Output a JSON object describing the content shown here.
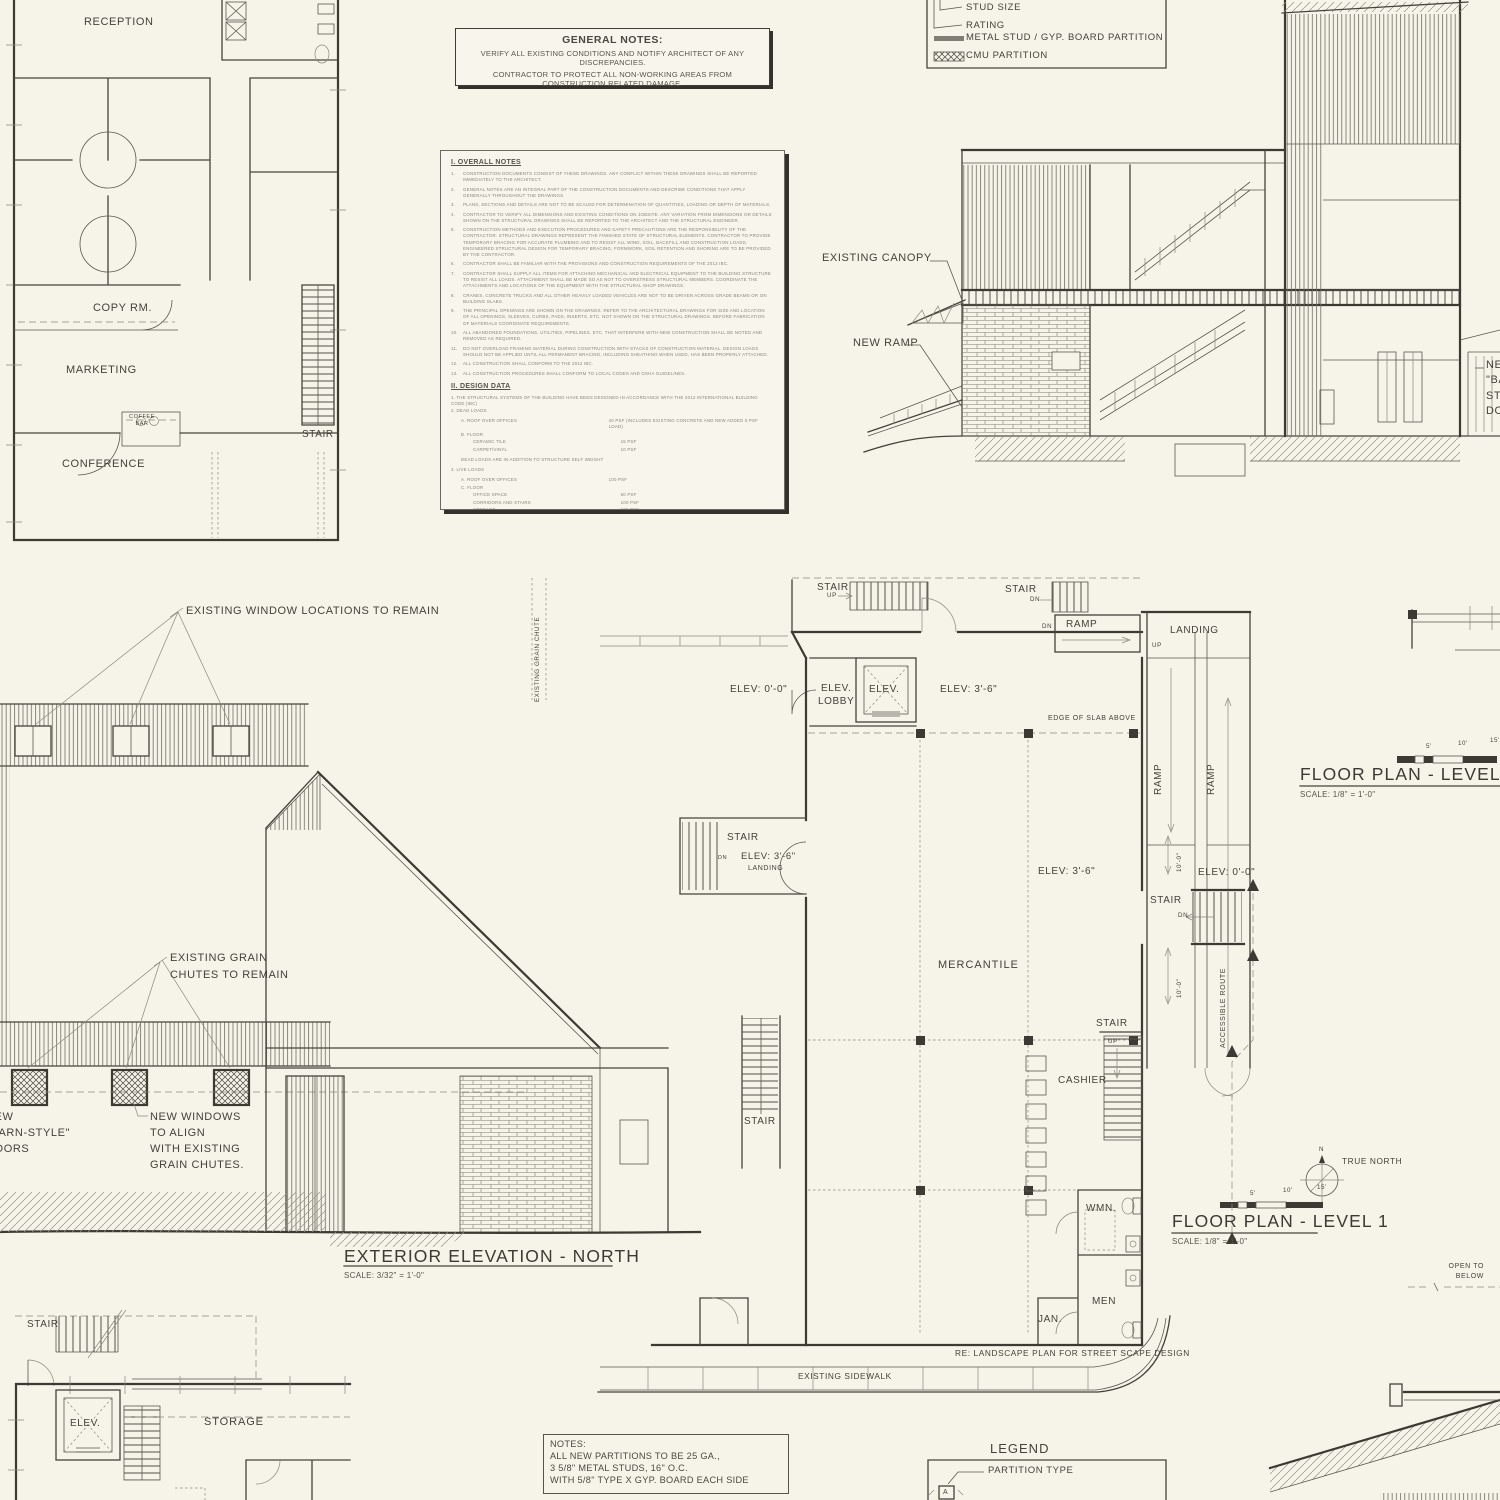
{
  "colors": {
    "background": "#f6f3e9",
    "ink": "#3f3d36",
    "ink_light": "#8a887c"
  },
  "office_plan": {
    "reception": "RECEPTION",
    "copy_room": "COPY RM.",
    "marketing": "MARKETING",
    "coffee_bar": "COFFEE\nBAR",
    "conference": "CONFERENCE",
    "stair": "STAIR"
  },
  "general_notes": {
    "title": "GENERAL NOTES:",
    "line1": "VERIFY ALL EXISTING CONDITIONS  AND NOTIFY ARCHITECT OF ANY DISCREPANCIES.",
    "line2": "CONTRACTOR TO PROTECT ALL NON-WORKING AREAS FROM CONSTRUCTION RELATED DAMAGE."
  },
  "notes_doc": {
    "section1_title": "I. OVERALL NOTES",
    "overall_notes": [
      {
        "n": "1.",
        "text": "CONSTRUCTION DOCUMENTS CONSIST OF THESE DRAWINGS. ANY CONFLICT WITHIN THESE DRAWINGS SHALL BE REPORTED IMMEDIATELY TO THE ARCHITECT."
      },
      {
        "n": "2.",
        "text": "GENERAL NOTES ARE AN INTEGRAL PART OF THE CONSTRUCTION DOCUMENTS AND DESCRIBE CONDITIONS THAT APPLY GENERALLY THROUGHOUT THE DRAWINGS."
      },
      {
        "n": "3.",
        "text": "PLANS, SECTIONS AND DETAILS ARE NOT TO BE SCALED FOR DETERMINATION OF QUANTITIES, LOADING OR DEPTH OF MATERIALS."
      },
      {
        "n": "4.",
        "text": "CONTRACTOR TO VERIFY ALL DIMENSIONS AND EXISTING CONDITIONS ON JOBSITE. ANY VARIATION FROM DIMENSIONS OR DETAILS SHOWN ON THE STRUCTURAL DRAWINGS SHALL BE REPORTED TO THE ARCHITECT AND THE STRUCTURAL ENGINEER."
      },
      {
        "n": "5.",
        "text": "CONSTRUCTION METHODS AND EXECUTION PROCEDURES AND SAFETY PRECAUTIONS ARE THE RESPONSIBILITY OF THE CONTRACTOR. STRUCTURAL DRAWINGS REPRESENT THE FINISHED STATE OF STRUCTURAL ELEMENTS. CONTRACTOR TO PROVIDE TEMPORARY BRACING FOR ACCURATE PLUMBING AND TO RESIST ALL WIND, SOIL, BACKFILL AND CONSTRUCTION LOADS. ENGINEERED STRUCTURAL DESIGN FOR TEMPORARY BRACING, FORMWORK, SOIL RETENTION AND SHORING ARE TO BE PROVIDED BY THE CONTRACTOR."
      },
      {
        "n": "6.",
        "text": "CONTRACTOR SHALL BE FAMILIAR WITH THE PROVISIONS AND CONSTRUCTION REQUIREMENTS OF THE 2012 IBC."
      },
      {
        "n": "7.",
        "text": "CONTRACTOR SHALL SUPPLY ALL ITEMS FOR ATTACHING MECHANICAL AND ELECTRICAL EQUIPMENT TO THE BUILDING STRUCTURE TO RESIST ALL LOADS. ATTACHMENT SHALL BE MADE SO AS NOT TO OVERSTRESS STRUCTURAL MEMBERS. COORDINATE THE ATTACHMENTS AND LOCATIONS OF THE EQUIPMENT WITH THE STRUCTURAL SHOP DRAWINGS."
      },
      {
        "n": "8.",
        "text": "CRANES, CONCRETE TRUCKS AND ALL OTHER HEAVILY LOADED VEHICLES ARE NOT TO BE DRIVEN ACROSS GRADE BEAMS OR ON BUILDING SLABS."
      },
      {
        "n": "9.",
        "text": "THE PRINCIPAL OPENINGS ARE SHOWN ON THE DRAWINGS. REFER TO THE ARCHITECTURAL DRAWINGS FOR SIZE AND LOCATION OF ALL OPENINGS, SLEEVES, CURBS, PADS, INSERTS, ETC. NOT SHOWN ON THE STRUCTURAL DRAWINGS. BEFORE FABRICATION OF MATERIALS COORDINATE REQUIREMENTS."
      },
      {
        "n": "10.",
        "text": "ALL ABANDONED FOUNDATIONS, UTILITIES, PIPELINES, ETC. THAT INTERFERE WITH NEW CONSTRUCTION SHALL BE NOTED AND REMOVED AS REQUIRED."
      },
      {
        "n": "11.",
        "text": "DO NOT OVERLOAD FRAMING MATERIAL DURING CONSTRUCTION WITH STACKS OF CONSTRUCTION MATERIAL. DESIGN LOADS SHOULD NOT BE APPLIED UNTIL ALL PERMANENT BRACING, INCLUDING SHEATHING WHEN USED, HAS BEEN PROPERLY ATTACHED."
      },
      {
        "n": "12.",
        "text": "ALL CONSTRUCTION SHALL CONFORM TO THE 2012 IBC."
      },
      {
        "n": "13.",
        "text": "ALL CONSTRUCTION PROCEDURES SHALL CONFORM TO LOCAL CODES AND OSHA GUIDELINES."
      }
    ],
    "section2_title": "II. DESIGN DATA",
    "design_data": [
      {
        "t": "1.   THE STRUCTURAL SYSTEMS OF THE BUILDING HAVE BEEN DESIGNED IN ACCORDANCE WITH THE 2012 INTERNATIONAL BUILDING CODE (IBC)",
        "v": ""
      },
      {
        "t": "2.   DEAD LOADS",
        "v": ""
      },
      {
        "t": "A. ROOF OVER OFFICES",
        "v": "40 PSF (INCLUDES EXISTING CONCRETE AND NEW ADDED 5 PSF LOAD)"
      },
      {
        "t": "B. FLOOR",
        "v": ""
      },
      {
        "t": "CERAMIC TILE",
        "v": "15 PSF"
      },
      {
        "t": "CARPET/VINYL",
        "v": "10 PSF"
      },
      {
        "t": "DEAD LOADS ARE IN ADDITION TO STRUCTURE SELF WEIGHT",
        "v": ""
      },
      {
        "t": "3.   LIVE LOADS",
        "v": ""
      },
      {
        "t": "A. ROOF OVER OFFICES",
        "v": "100 PSF"
      },
      {
        "t": "C. FLOOR",
        "v": ""
      },
      {
        "t": "OFFICE SPACE",
        "v": "50 PSF"
      },
      {
        "t": "CORRIDORS AND STAIRS",
        "v": "100 PSF"
      },
      {
        "t": "STORAGE",
        "v": "125 PSF"
      },
      {
        "t": "D. GUARDRAILS AND HANDRAILS",
        "v": "50 PLF OR 200 LBS IN ANY DIRECTION AT ANY POINT ALONG THE TOP"
      },
      {
        "t": "4.   WIND",
        "v": ""
      },
      {
        "t": "A. SPEED",
        "v": "90 MPH"
      },
      {
        "t": "B. OCCUPANCY CATEGORY",
        "v": "II"
      },
      {
        "t": "C. IMPORTANCE FACTOR",
        "v": "1.0"
      },
      {
        "t": "D. EXPOSURE",
        "v": "B"
      }
    ]
  },
  "legend_top": {
    "stud_size": "STUD SIZE",
    "rating": "RATING",
    "metal_partition": "METAL STUD / GYP. BOARD PARTITION",
    "cmu_partition": "CMU PARTITION"
  },
  "section_view": {
    "existing_canopy": "EXISTING CANOPY",
    "new_ramp": "NEW RAMP",
    "barn_doors_label": "NEW\n\"BARN-STYLE\"\nDOORS"
  },
  "elevation": {
    "windows_note": "EXISTING WINDOW LOCATIONS TO REMAIN",
    "chutes_note": "EXISTING GRAIN\nCHUTES TO REMAIN",
    "new_windows_note": "NEW WINDOWS\nTO ALIGN\nWITH EXISTING\nGRAIN CHUTES.",
    "title": "EXTERIOR ELEVATION - NORTH",
    "scale": "SCALE: 3/32\" = 1'-0\""
  },
  "plan1": {
    "stair": "STAIR",
    "ramp": "RAMP",
    "landing": "LANDING",
    "elev_lobby": "ELEV.\nLOBBY",
    "elev": "ELEV.",
    "elev_0": "ELEV: 0'-0\"",
    "elev_36": "ELEV: 3'-6\"",
    "edge_of_slab": "EDGE OF SLAB ABOVE",
    "mercantile": "MERCANTILE",
    "cashier": "CASHIER",
    "accessible_route": "ACCESSIBLE ROUTE",
    "wmn": "WMN.",
    "men": "MEN",
    "jan": "JAN.",
    "landing_small": "LANDING",
    "up": "UP",
    "dn": "DN",
    "dim_10": "10'-0\"",
    "grain_chute": "EXISTING GRAIN CHUTE",
    "re_landscape": "RE: LANDSCAPE PLAN FOR STREET SCAPE DESIGN",
    "sidewalk": "EXISTING SIDEWALK"
  },
  "plan1_title": {
    "title": "FLOOR PLAN - LEVEL 1",
    "scale": "SCALE: 1/8\" = 1'-0\"",
    "true_north": "TRUE NORTH",
    "north_n": "N",
    "tick_5": "5'",
    "tick_10": "10'",
    "tick_15": "15'"
  },
  "plan2_title": {
    "title": "FLOOR PLAN - LEVEL 2",
    "scale": "SCALE: 1/8\" = 1'-0\"",
    "tick_5": "5'",
    "tick_10": "10'",
    "tick_15": "15'"
  },
  "open_to_below": "OPEN TO\nBELOW",
  "storage_plan": {
    "stair": "STAIR",
    "elev": "ELEV.",
    "storage": "STORAGE"
  },
  "notes_box": {
    "text": "NOTES:\nALL NEW PARTITIONS TO BE 25 GA.,\n3 5/8\" METAL STUDS, 16\" O.C.\nWITH 5/8\" TYPE X GYP. BOARD EACH SIDE"
  },
  "legend_bottom": {
    "title": "LEGEND",
    "partition_type": "PARTITION TYPE",
    "symbol_a": "A"
  }
}
